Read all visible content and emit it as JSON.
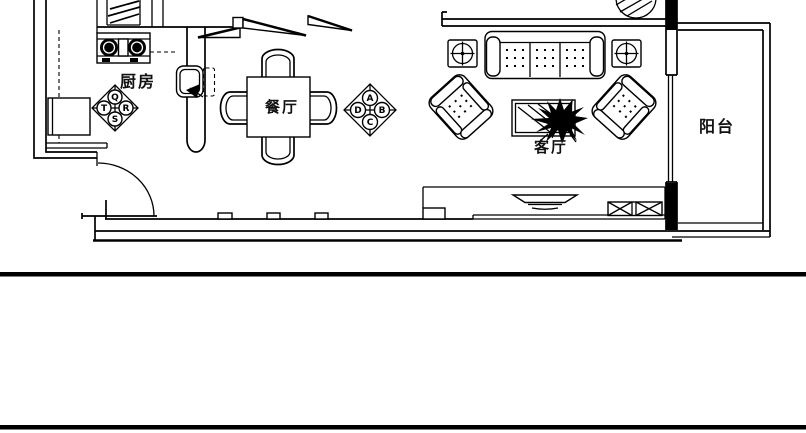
{
  "rooms": {
    "kitchen": {
      "label": "厨房"
    },
    "dining": {
      "label": "餐厅"
    },
    "living": {
      "label": "客厅"
    },
    "balcony": {
      "label": "阳台"
    }
  },
  "finish_tags": {
    "kitchen": {
      "top": "Q",
      "right": "R",
      "bottom": "S",
      "left": "T"
    },
    "dining": {
      "top": "A",
      "right": "B",
      "bottom": "C",
      "left": "D"
    }
  },
  "colors": {
    "line": "#000000",
    "background": "#ffffff"
  }
}
